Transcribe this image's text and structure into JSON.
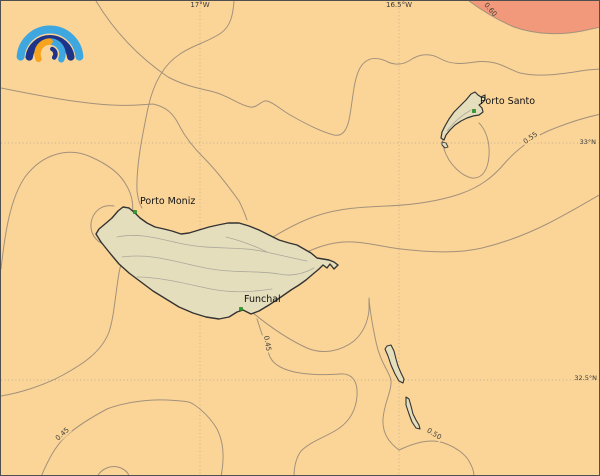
{
  "map": {
    "graticule": {
      "meridians": [
        {
          "label": "17°W"
        },
        {
          "label": "16.5°W"
        }
      ],
      "parallels": [
        {
          "label": "33°N"
        },
        {
          "label": "32.5°N"
        }
      ]
    },
    "places": {
      "porto_santo": "Porto Santo",
      "porto_moniz": "Porto Moniz",
      "funchal": "Funchal"
    },
    "contour_labels": {
      "c060": "0.60",
      "c055": "0.55",
      "c050": "0.50",
      "c045_mid": "0.45",
      "c045_sw": "0.45"
    },
    "colors": {
      "ocean": "#FBD598",
      "high_value_region": "#F2997B",
      "land": "#E5DEBC",
      "contour_line": "#A3917A",
      "coastline": "#333333",
      "town_marker": "#2F9E2B",
      "logo_light_blue": "#3EA7E0",
      "logo_navy": "#1D3489",
      "logo_orange": "#F6A41E"
    }
  }
}
